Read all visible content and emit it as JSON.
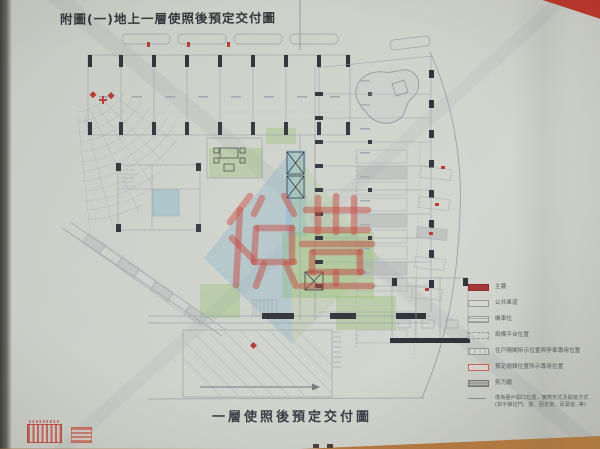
{
  "document": {
    "top_title": "附圖(一)地上一層使照後預定交付圖",
    "bottom_title": "一層使照後預定交付圖",
    "watermark": {
      "text": "裕豐",
      "color": "#c2453c"
    },
    "stamps": [
      {
        "name": "red-seal-stamp-large"
      },
      {
        "name": "red-seal-stamp-small"
      }
    ]
  },
  "legend": {
    "items": [
      {
        "swatch": "solid-red",
        "color": "#a83838",
        "label": "主牆"
      },
      {
        "swatch": "light-fill",
        "color": "#d6d7d1",
        "label": "公共車道"
      },
      {
        "swatch": "hatched",
        "color": "#a8aaa6",
        "label": "機車位"
      },
      {
        "swatch": "dashed-outline",
        "color": "#9a9a94",
        "label": "設備平台位置"
      },
      {
        "swatch": "ticked-fill",
        "color": "#c4c6c1",
        "label": "住戶隔間所示位置與停車專用位置"
      },
      {
        "swatch": "pink-outline",
        "color": "#c86858",
        "label": "預定總錶位置所示專用位置"
      },
      {
        "swatch": "dark-hatched",
        "color": "#8f908c",
        "label": "剪力牆"
      },
      {
        "swatch": "line-sample",
        "color": "#8a8d90",
        "label": "僅為圈戶開口位置，實際形式及開窗方式(如平推拉門、窗、固定窗、百葉窗..等)"
      }
    ]
  },
  "plan": {
    "zones": [
      {
        "name": "landscaped-area",
        "color": "#9ebe73"
      },
      {
        "name": "elevator-core",
        "color": "#78b4cd"
      },
      {
        "name": "pond",
        "color": "#8a90a0"
      },
      {
        "name": "parking-stalls",
        "color": "#c6c9cc"
      },
      {
        "name": "ramp-driveway",
        "color": "#b6bac0"
      }
    ]
  }
}
